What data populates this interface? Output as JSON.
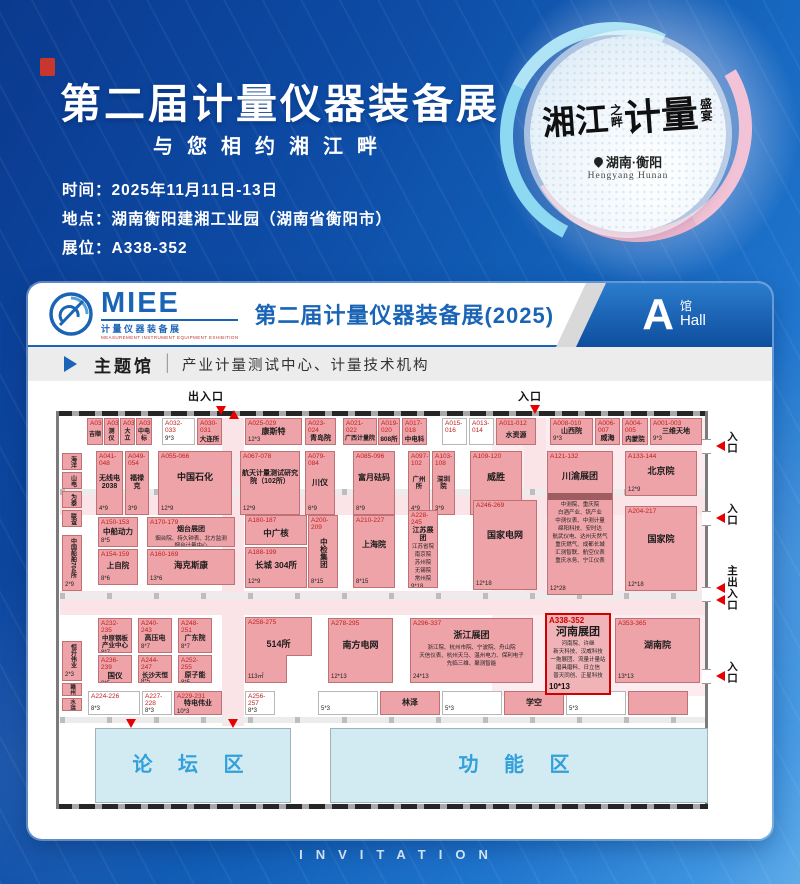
{
  "header": {
    "title": "第二届计量仪器装备展",
    "subtitle": "与您相约湘江畔",
    "info": [
      {
        "label": "时间：",
        "value": "2025年11月11日-13日"
      },
      {
        "label": "地点：",
        "value": "湖南衡阳建湘工业园（湖南省衡阳市）"
      },
      {
        "label": "展位：",
        "value": "A338-352"
      }
    ],
    "badge": {
      "cal_big1": "湘江",
      "cal_small1": "之畔",
      "cal_big2": "计量",
      "cal_small2": "盛宴",
      "location": "湖南·衡阳",
      "location_en": "Hengyang Hunan"
    }
  },
  "card": {
    "logo": {
      "name": "MIEE",
      "sub_cn": "计量仪器装备展",
      "sub_en": "MEASUREMENT INSTRUMENT EQUIPMENT EXHIBITION"
    },
    "title": "第二届计量仪器装备展(2025)",
    "hall": {
      "letter": "A",
      "cn": "馆",
      "en": "Hall"
    },
    "theme": {
      "label": "主题馆",
      "divider": "│",
      "desc": "产业计量测试中心、计量技术机构"
    }
  },
  "invitation_text": "INVITATION",
  "colors": {
    "accent_blue": "#1a64b6",
    "booth_pink": "#eea3a8",
    "highlight_red": "#cf0000",
    "zone_blue": "#d2ebf2",
    "entrance_red": "#e60000"
  },
  "floorplan": {
    "entrances": {
      "top_main": "出入口",
      "top": "入口",
      "right1": "入口",
      "right2": "入口",
      "right_main": "主出入口",
      "right3": "入口"
    },
    "highlight_booth": "A338-352",
    "booths": [
      {
        "id": "A038",
        "name": "吉顺",
        "x": 31,
        "y": 15,
        "w": 16,
        "h": 27,
        "fs": 6
      },
      {
        "id": "A037",
        "name": "测仪",
        "x": 48,
        "y": 15,
        "w": 15,
        "h": 27,
        "fs": 6
      },
      {
        "id": "A036",
        "name": "大立",
        "x": 64,
        "y": 15,
        "w": 15,
        "h": 27,
        "fs": 6
      },
      {
        "id": "A035",
        "name": "中电标",
        "x": 80,
        "y": 15,
        "w": 16,
        "h": 27,
        "fs": 6
      },
      {
        "id": "A032-033",
        "size": "9*3",
        "x": 106,
        "y": 15,
        "w": 33,
        "h": 27,
        "type": "w"
      },
      {
        "id": "A030-031",
        "name": "大连所",
        "x": 141,
        "y": 15,
        "w": 25,
        "h": 27,
        "fs": 6.5
      },
      {
        "id": "A025-029",
        "name": "康斯特",
        "size": "12*3",
        "x": 189,
        "y": 15,
        "w": 57,
        "h": 27,
        "fs": 8
      },
      {
        "id": "A023-024",
        "name": "青岛院",
        "x": 249,
        "y": 15,
        "w": 31,
        "h": 27,
        "fs": 7
      },
      {
        "id": "A021-022",
        "name": "广西计量院",
        "x": 287,
        "y": 15,
        "w": 34,
        "h": 27,
        "fs": 6
      },
      {
        "id": "A019-020",
        "name": "808所",
        "x": 322,
        "y": 15,
        "w": 22,
        "h": 27,
        "fs": 6.5
      },
      {
        "id": "A017-018",
        "name": "中电科",
        "x": 346,
        "y": 15,
        "w": 25,
        "h": 27,
        "fs": 6.5
      },
      {
        "id": "A015-016",
        "x": 386,
        "y": 15,
        "w": 25,
        "h": 27,
        "type": "w"
      },
      {
        "id": "A013-014",
        "x": 413,
        "y": 15,
        "w": 25,
        "h": 27,
        "type": "w"
      },
      {
        "id": "A011-012",
        "name": "水资源",
        "x": 440,
        "y": 15,
        "w": 40,
        "h": 27,
        "fs": 7
      },
      {
        "id": "A008-010",
        "name": "山西院",
        "size": "9*3",
        "x": 494,
        "y": 15,
        "w": 43,
        "h": 27,
        "fs": 7
      },
      {
        "id": "A006-007",
        "name": "威海",
        "x": 539,
        "y": 15,
        "w": 25,
        "h": 27,
        "fs": 7
      },
      {
        "id": "A004-005",
        "name": "内蒙院",
        "x": 566,
        "y": 15,
        "w": 26,
        "h": 27,
        "fs": 6.5
      },
      {
        "id": "A001-003",
        "name": "三维天地",
        "size": "9*3",
        "x": 594,
        "y": 15,
        "w": 52,
        "h": 27,
        "fs": 7
      },
      {
        "id": "A041-048",
        "name": "无线电 2038",
        "size": "4*9",
        "x": 40,
        "y": 48,
        "w": 27,
        "h": 64,
        "fs": 7
      },
      {
        "id": "A049-054",
        "name": "福禄克",
        "size": "3*9",
        "x": 69,
        "y": 48,
        "w": 24,
        "h": 64,
        "fs": 7
      },
      {
        "id": "A055-066",
        "name": "中国石化",
        "size": "12*9",
        "x": 102,
        "y": 48,
        "w": 74,
        "h": 64,
        "fs": 9
      },
      {
        "id": "A067-078",
        "name": "航天计量测试研究院（102所）",
        "size": "12*9",
        "x": 184,
        "y": 48,
        "w": 60,
        "h": 64,
        "fs": 7
      },
      {
        "id": "A079-084",
        "name": "川仪",
        "size": "6*9",
        "x": 249,
        "y": 48,
        "w": 30,
        "h": 64,
        "fs": 8
      },
      {
        "id": "A085-096",
        "name": "富月砝码",
        "size": "8*9",
        "x": 297,
        "y": 48,
        "w": 42,
        "h": 64,
        "fs": 8
      },
      {
        "id": "A097-102",
        "name": "广州所",
        "size": "4*9",
        "x": 352,
        "y": 48,
        "w": 22,
        "h": 64,
        "fs": 6.5
      },
      {
        "id": "A103-108",
        "name": "深圳院",
        "size": "3*9",
        "x": 376,
        "y": 48,
        "w": 23,
        "h": 64,
        "fs": 6.5
      },
      {
        "id": "A109-120",
        "name": "威胜",
        "size": "12*9",
        "x": 414,
        "y": 48,
        "w": 52,
        "h": 64,
        "fs": 9
      },
      {
        "id": "A121-132",
        "name": "川渝展团",
        "size": "12*28",
        "x": 491,
        "y": 48,
        "w": 66,
        "h": 144,
        "fs": 9,
        "band": true,
        "list": [
          "中测院、重庆院",
          "白酒产业、钒产业",
          "中测仪表、中测计量",
          "绵阳科技、安时达",
          "航武仪电、达州天然气",
          "重庆燃气、成都长城",
          "汇测智联、航空仪表",
          "重庆水务、宁江仪表"
        ]
      },
      {
        "id": "A133-144",
        "name": "北京院",
        "size": "12*9",
        "x": 569,
        "y": 48,
        "w": 72,
        "h": 45,
        "fs": 9
      },
      {
        "id": "A204-217",
        "name": "国家院",
        "size": "12*18",
        "x": 569,
        "y": 103,
        "w": 72,
        "h": 85,
        "fs": 9
      },
      {
        "id": "A150-153",
        "name": "中船动力",
        "size": "8*5",
        "x": 42,
        "y": 114,
        "w": 40,
        "h": 30,
        "fs": 7.5
      },
      {
        "id": "A154-159",
        "name": "上自院",
        "size": "8*6",
        "x": 42,
        "y": 146,
        "w": 40,
        "h": 36,
        "fs": 7.5
      },
      {
        "id": "A170-179",
        "name": "烟台展团",
        "size": "13*5",
        "x": 91,
        "y": 114,
        "w": 88,
        "h": 30,
        "fs": 7,
        "list": [
          "烟台院、持久钟表、北方监测",
          "烟台计量中心"
        ]
      },
      {
        "id": "A160-169",
        "name": "海克斯康",
        "size": "13*6",
        "x": 91,
        "y": 146,
        "w": 88,
        "h": 36,
        "fs": 8.5
      },
      {
        "id": "A180-187",
        "name": "中广核",
        "x": 189,
        "y": 112,
        "w": 62,
        "h": 30,
        "fs": 8.5
      },
      {
        "id": "A188-199",
        "name": "长城 304所",
        "size": "12*9",
        "x": 189,
        "y": 144,
        "w": 62,
        "h": 41,
        "fs": 8.5
      },
      {
        "id": "A200-209",
        "name": "中检集团",
        "size": "8*15",
        "x": 252,
        "y": 112,
        "w": 30,
        "h": 73,
        "fs": 7.5,
        "type": "v"
      },
      {
        "id": "A210-227",
        "name": "上海院",
        "size": "8*15",
        "x": 297,
        "y": 112,
        "w": 42,
        "h": 73,
        "fs": 8
      },
      {
        "id": "A228-245",
        "name": "江苏展团",
        "size": "9*18",
        "x": 352,
        "y": 107,
        "w": 30,
        "h": 78,
        "fs": 7,
        "list": [
          "江苏省院",
          "南京院",
          "苏州院",
          "无锡院",
          "常州院"
        ]
      },
      {
        "id": "A246-269",
        "name": "国家电网",
        "size": "12*18",
        "x": 417,
        "y": 97,
        "w": 64,
        "h": 90,
        "fs": 9
      },
      {
        "id": "A232-235",
        "name": "中原钢板产业中心",
        "size": "8*7",
        "x": 42,
        "y": 215,
        "w": 34,
        "h": 35,
        "fs": 6.5
      },
      {
        "id": "A236-239",
        "name": "国仪",
        "size": "8*5",
        "x": 42,
        "y": 252,
        "w": 34,
        "h": 28,
        "fs": 7.5
      },
      {
        "id": "A240-243",
        "name": "高压电",
        "size": "8*7",
        "x": 82,
        "y": 215,
        "w": 34,
        "h": 35,
        "fs": 7
      },
      {
        "id": "A244-247",
        "name": "长沙天恒",
        "size": "8*5",
        "x": 82,
        "y": 252,
        "w": 34,
        "h": 28,
        "fs": 6.5
      },
      {
        "id": "A248-251",
        "name": "广东院",
        "size": "8*7",
        "x": 122,
        "y": 215,
        "w": 34,
        "h": 35,
        "fs": 7
      },
      {
        "id": "A252-255",
        "name": "原子能",
        "size": "8*5",
        "x": 122,
        "y": 252,
        "w": 34,
        "h": 28,
        "fs": 7
      },
      {
        "id": "A258-275",
        "name": "514所",
        "size": "113㎡",
        "x": 189,
        "y": 214,
        "w": 67,
        "h": 66,
        "fs": 9
      },
      {
        "x": 230,
        "y": 252,
        "w": 26,
        "h": 28,
        "type": "notch"
      },
      {
        "id": "A278-295",
        "name": "南方电网",
        "size": "12*13",
        "x": 272,
        "y": 215,
        "w": 65,
        "h": 65,
        "fs": 9
      },
      {
        "id": "A296-337",
        "name": "浙江展团",
        "size": "24*13",
        "x": 354,
        "y": 215,
        "w": 123,
        "h": 65,
        "fs": 9,
        "list": [
          "浙江院、杭州市院、宁波院、舟山院",
          "天信仪表、杭州天马、温州电力、保利电子",
          "先临三维、聚测智能"
        ]
      },
      {
        "id": "A338-352",
        "name": "河南展团",
        "size": "10*13",
        "x": 489,
        "y": 210,
        "w": 66,
        "h": 82,
        "type": "hl",
        "list": [
          "河南院、许继",
          "新天科技、汉威科技",
          "一拖展团、流量计量站",
          "磨具磨料、日立信",
          "普天同创、正星科技"
        ]
      },
      {
        "id": "A353-365",
        "name": "湖南院",
        "size": "13*13",
        "x": 559,
        "y": 215,
        "w": 85,
        "h": 65,
        "fs": 9
      },
      {
        "id": "A224-226",
        "size": "8*3",
        "x": 32,
        "y": 288,
        "w": 52,
        "h": 24,
        "type": "w"
      },
      {
        "id": "A227-228",
        "size": "8*3",
        "x": 86,
        "y": 288,
        "w": 30,
        "h": 24,
        "type": "w"
      },
      {
        "id": "A229-231",
        "name": "特电伟业",
        "size": "10*3",
        "x": 118,
        "y": 288,
        "w": 48,
        "h": 24,
        "fs": 7
      },
      {
        "id": "A256-257",
        "size": "8*3",
        "x": 189,
        "y": 288,
        "w": 30,
        "h": 24,
        "type": "w"
      },
      {
        "size": "5*3",
        "x": 262,
        "y": 288,
        "w": 60,
        "h": 24,
        "type": "w"
      },
      {
        "name": "林泽",
        "x": 324,
        "y": 288,
        "w": 60,
        "h": 24,
        "fs": 8
      },
      {
        "size": "5*3",
        "x": 386,
        "y": 288,
        "w": 60,
        "h": 24,
        "type": "w"
      },
      {
        "name": "学空",
        "x": 448,
        "y": 288,
        "w": 60,
        "h": 24,
        "fs": 8
      },
      {
        "size": "5*3",
        "x": 510,
        "y": 288,
        "w": 60,
        "h": 24,
        "type": "w"
      },
      {
        "x": 572,
        "y": 288,
        "w": 60,
        "h": 24
      },
      {
        "name": "海洋",
        "x": 6,
        "y": 50,
        "w": 20,
        "h": 17,
        "type": "v",
        "fs": 6
      },
      {
        "name": "山电",
        "x": 6,
        "y": 69,
        "w": 20,
        "h": 17,
        "type": "v",
        "fs": 6
      },
      {
        "name": "为泰",
        "x": 6,
        "y": 88,
        "w": 20,
        "h": 17,
        "type": "v",
        "fs": 6
      },
      {
        "name": "联谊",
        "x": 6,
        "y": 107,
        "w": 20,
        "h": 17,
        "type": "v",
        "fs": 6
      },
      {
        "name": "中国船舶704所",
        "size": "2*9",
        "x": 6,
        "y": 132,
        "w": 20,
        "h": 56,
        "type": "v",
        "fs": 6
      },
      {
        "name": "恒升伟业",
        "size": "2*3",
        "x": 6,
        "y": 238,
        "w": 20,
        "h": 40,
        "type": "v",
        "fs": 6
      },
      {
        "name": "赣州",
        "x": 6,
        "y": 280,
        "w": 20,
        "h": 13,
        "type": "v",
        "fs": 5.5
      },
      {
        "name": "水运",
        "x": 6,
        "y": 295,
        "w": 20,
        "h": 13,
        "type": "v",
        "fs": 5.5
      },
      {
        "name": "论 坛 区",
        "x": 39,
        "y": 325,
        "w": 196,
        "h": 75,
        "type": "zone"
      },
      {
        "name": "功 能 区",
        "x": 274,
        "y": 325,
        "w": 378,
        "h": 75,
        "type": "zone"
      }
    ]
  }
}
